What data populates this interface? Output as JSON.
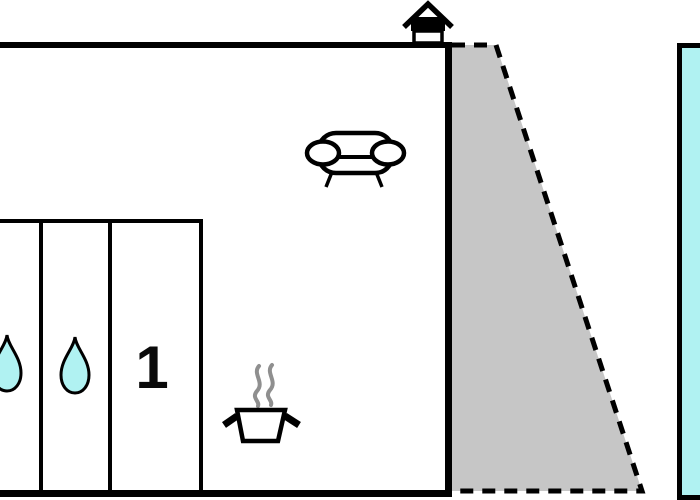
{
  "plan": {
    "colors": {
      "background": "#ffffff",
      "line": "#000000",
      "water": "#b0f2f2",
      "terrace": "#c6c6c6",
      "steam": "#8f8f8f"
    },
    "rooms": {
      "bedroom": {
        "label": "1"
      },
      "bathroom_left": {
        "icon": "water-drop-icon"
      },
      "bathroom_right": {
        "icon": "water-drop-icon"
      },
      "living_room": {
        "icon": "sofa-icon"
      },
      "kitchen": {
        "icon": "cooking-pot-icon"
      }
    },
    "outdoor": {
      "entrance_marker": {
        "icon": "house-icon"
      },
      "terrace": {
        "outline": "dashed"
      },
      "pool": {
        "icon": "pool-area"
      }
    }
  }
}
